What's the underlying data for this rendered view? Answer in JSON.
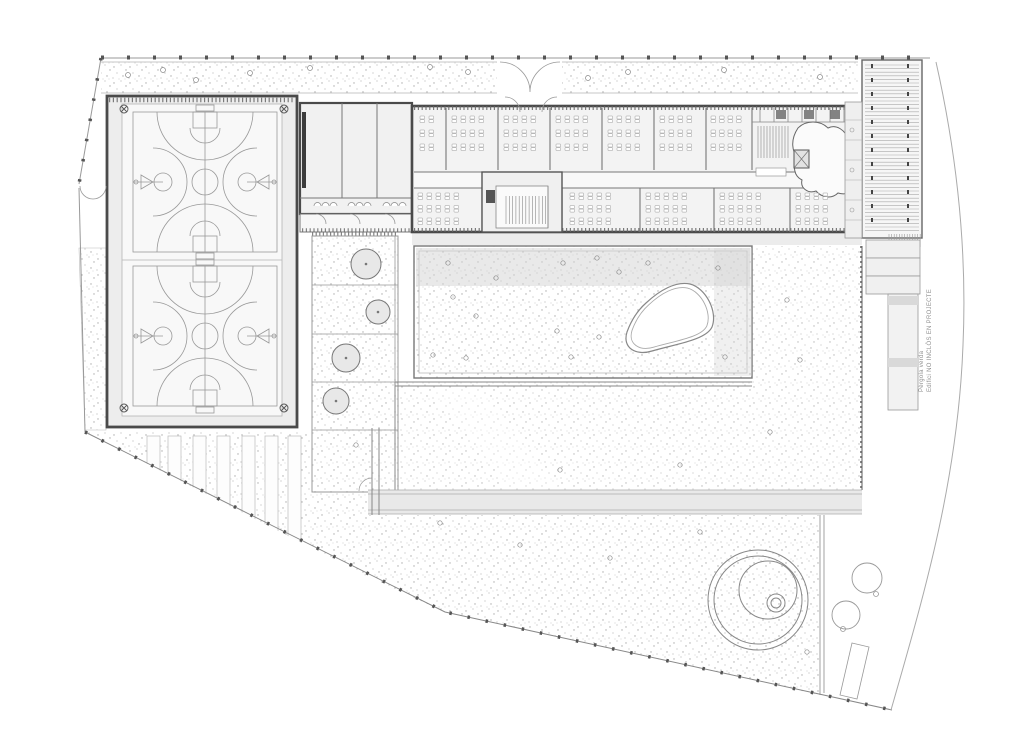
{
  "annotation": {
    "line1": "Pèrgola verda",
    "line2": "Edifici NO INCLÒS EN PROJECTE"
  },
  "colors": {
    "background": "#ffffff",
    "wall": "#4a4a4a",
    "line": "#8a8a8a",
    "stipple_dot": "#8f8f8f",
    "shadow": "#d6d6d6",
    "gym_floor": "#ededed",
    "room_fill": "#f3f3f3",
    "path_band": "#e9e9e9"
  },
  "drawing": {
    "courts": {
      "x": 133,
      "w": 144,
      "cx": 205,
      "halls": [
        {
          "y": 112,
          "h": 140
        },
        {
          "y": 266,
          "h": 140
        }
      ],
      "corner_markers": [
        [
          124,
          109
        ],
        [
          284,
          109
        ],
        [
          124,
          408
        ],
        [
          284,
          408
        ]
      ]
    },
    "desk_rooms": [
      {
        "x": 420,
        "y": 116,
        "cols": 2,
        "rows": 3,
        "dx": 9,
        "dy": 14
      },
      {
        "x": 452,
        "y": 116,
        "cols": 4,
        "rows": 3,
        "dx": 9,
        "dy": 14
      },
      {
        "x": 504,
        "y": 116,
        "cols": 4,
        "rows": 3,
        "dx": 9,
        "dy": 14
      },
      {
        "x": 556,
        "y": 116,
        "cols": 4,
        "rows": 3,
        "dx": 9,
        "dy": 14
      },
      {
        "x": 608,
        "y": 116,
        "cols": 4,
        "rows": 3,
        "dx": 9,
        "dy": 14
      },
      {
        "x": 660,
        "y": 116,
        "cols": 4,
        "rows": 3,
        "dx": 9,
        "dy": 14
      },
      {
        "x": 711,
        "y": 116,
        "cols": 4,
        "rows": 3,
        "dx": 8.5,
        "dy": 14
      },
      {
        "x": 418,
        "y": 193,
        "cols": 5,
        "rows": 3,
        "dx": 9,
        "dy": 12.5
      },
      {
        "x": 570,
        "y": 193,
        "cols": 5,
        "rows": 3,
        "dx": 9,
        "dy": 12.5
      },
      {
        "x": 646,
        "y": 193,
        "cols": 5,
        "rows": 3,
        "dx": 9,
        "dy": 12.5
      },
      {
        "x": 720,
        "y": 193,
        "cols": 5,
        "rows": 3,
        "dx": 9,
        "dy": 12.5
      },
      {
        "x": 796,
        "y": 193,
        "cols": 4,
        "rows": 3,
        "dx": 9,
        "dy": 12.5
      }
    ],
    "planter_trees": [
      {
        "cx": 366,
        "cy": 264,
        "r": 15
      },
      {
        "cx": 378,
        "cy": 312,
        "r": 12
      },
      {
        "cx": 346,
        "cy": 358,
        "r": 14
      },
      {
        "cx": 336,
        "cy": 401,
        "r": 13
      }
    ],
    "site_trees": [
      {
        "cx": 867,
        "cy": 578,
        "r": 15,
        "dotx": 876,
        "doty": 594
      },
      {
        "cx": 846,
        "cy": 615,
        "r": 14,
        "dotx": 843,
        "doty": 629
      }
    ],
    "drains": [
      [
        448,
        263
      ],
      [
        563,
        263
      ],
      [
        597,
        258
      ],
      [
        648,
        263
      ],
      [
        619,
        272
      ],
      [
        718,
        268
      ],
      [
        496,
        278
      ],
      [
        453,
        297
      ],
      [
        476,
        316
      ],
      [
        557,
        331
      ],
      [
        599,
        337
      ],
      [
        433,
        355
      ],
      [
        466,
        358
      ],
      [
        571,
        357
      ],
      [
        725,
        357
      ],
      [
        787,
        300
      ],
      [
        800,
        360
      ],
      [
        770,
        432
      ],
      [
        560,
        470
      ],
      [
        680,
        465
      ],
      [
        440,
        523
      ],
      [
        520,
        545
      ],
      [
        610,
        558
      ],
      [
        700,
        532
      ],
      [
        807,
        652
      ],
      [
        356,
        445
      ]
    ],
    "strip_circles": [
      [
        128,
        75
      ],
      [
        163,
        70
      ],
      [
        196,
        80
      ],
      [
        250,
        73
      ],
      [
        310,
        68
      ],
      [
        430,
        67
      ],
      [
        468,
        72
      ],
      [
        588,
        78
      ],
      [
        628,
        72
      ],
      [
        724,
        70
      ],
      [
        820,
        77
      ]
    ],
    "parking": {
      "xs": [
        147,
        168,
        193,
        217,
        242,
        265,
        288
      ],
      "w": 13,
      "top": 436,
      "slope": 0.5
    },
    "pergola": {
      "main": {
        "x1": 865,
        "x2": 919,
        "y1": 65,
        "y2": 231,
        "step": 3.6
      },
      "lower": {
        "x1": 890,
        "x2": 916,
        "y1": 298,
        "y2": 407,
        "step": 4
      },
      "hatch": {
        "x1": 889,
        "x2": 921,
        "y1": 234,
        "y2": 247,
        "step": 2.6
      }
    },
    "stairs": [
      {
        "x1": 506,
        "x2": 546,
        "y1": 196,
        "y2": 224,
        "step": 3.3
      },
      {
        "x1": 758,
        "x2": 790,
        "y1": 126,
        "y2": 158,
        "step": 3
      }
    ],
    "fountain": {
      "circles": [
        {
          "cx": 758,
          "cy": 600,
          "r": 50
        },
        {
          "cx": 758,
          "cy": 600,
          "r": 44
        },
        {
          "cx": 768,
          "cy": 590,
          "r": 29
        },
        {
          "cx": 776,
          "cy": 603,
          "r": 9
        },
        {
          "cx": 776,
          "cy": 603,
          "r": 5
        }
      ]
    }
  }
}
